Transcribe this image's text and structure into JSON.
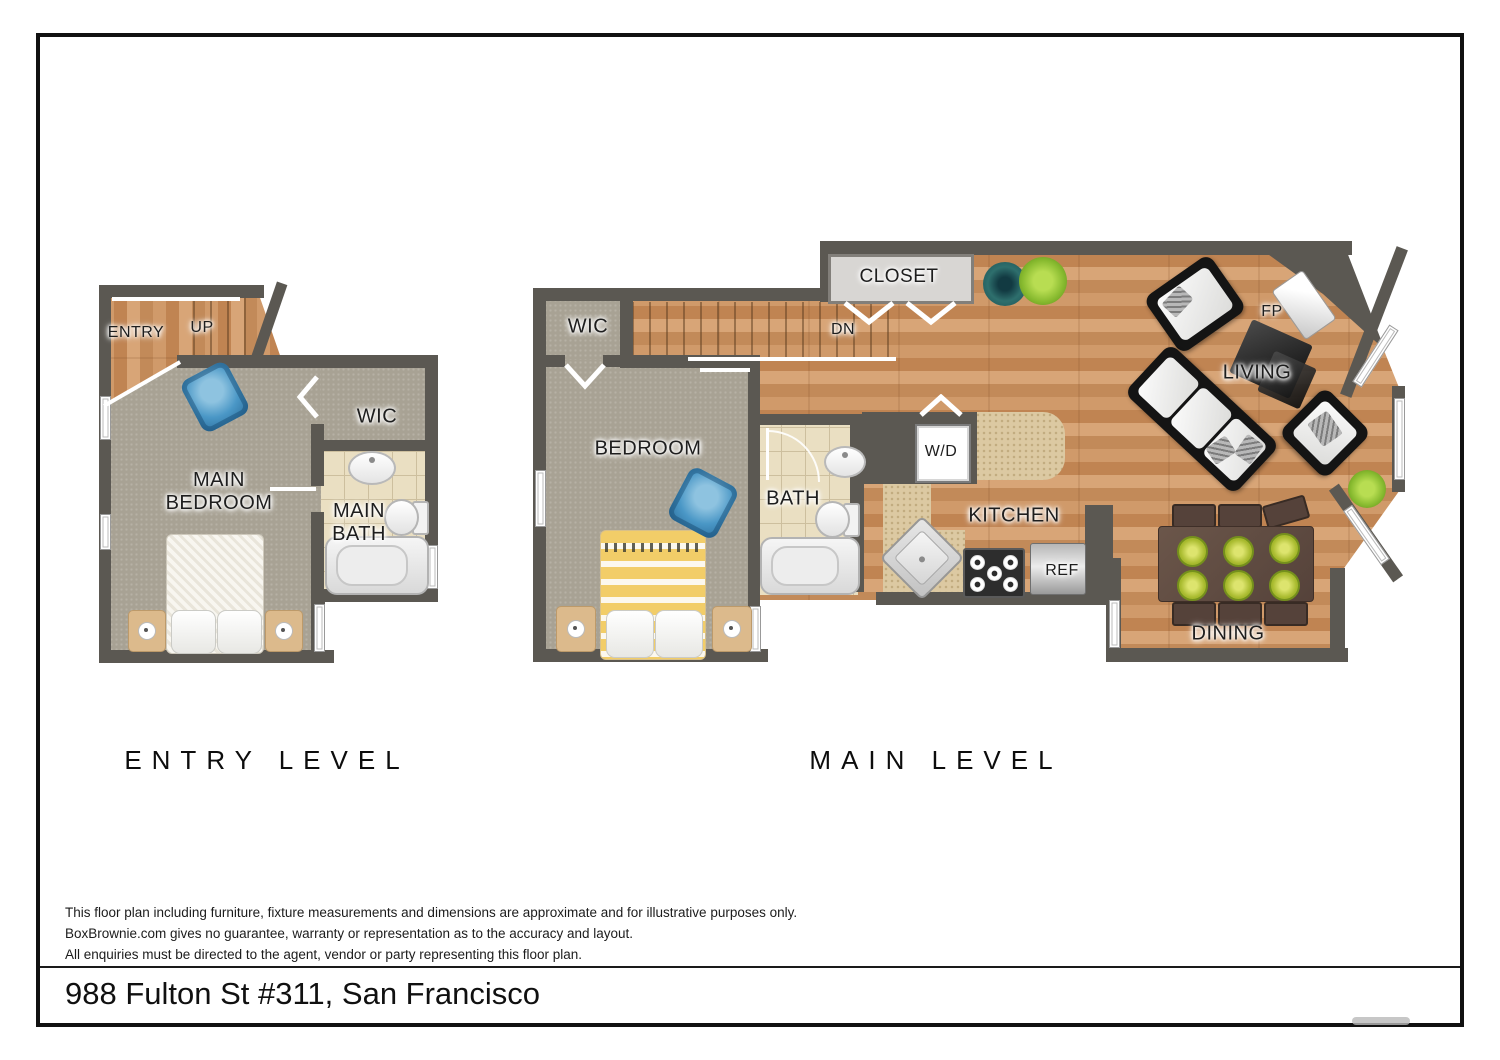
{
  "meta": {
    "address": "988 Fulton St #311, San Francisco"
  },
  "disclaimer": {
    "line1": "This floor plan including furniture, fixture measurements and dimensions are approximate and for illustrative purposes only.",
    "line2": "BoxBrownie.com gives no guarantee, warranty or representation as to the accuracy and layout.",
    "line3": "All enquiries must be directed to the agent, vendor or party representing this floor plan."
  },
  "levels": {
    "entry": {
      "title": "ENTRY LEVEL",
      "rooms": {
        "entry": "ENTRY",
        "up": "UP",
        "wic": "WIC",
        "main_bedroom": "MAIN BEDROOM",
        "main_bath": "MAIN BATH"
      }
    },
    "main": {
      "title": "MAIN LEVEL",
      "rooms": {
        "wic": "WIC",
        "dn": "DN",
        "closet": "CLOSET",
        "bedroom": "BEDROOM",
        "bath": "BATH",
        "wd": "W/D",
        "kitchen": "KITCHEN",
        "ref": "REF",
        "living": "LIVING",
        "fp": "FP",
        "dining": "DINING"
      }
    }
  },
  "colors": {
    "wall": "#5b5852",
    "wood": "#c98a58",
    "carpet": "#a8a294",
    "tile": "#eadfc2",
    "counter": "#dcc9a2",
    "accent_chair_blue": "#4a97c6",
    "plate_green": "#a9bb2f",
    "sofa_black": "#141414",
    "dining_table_brown": "#55423a"
  }
}
